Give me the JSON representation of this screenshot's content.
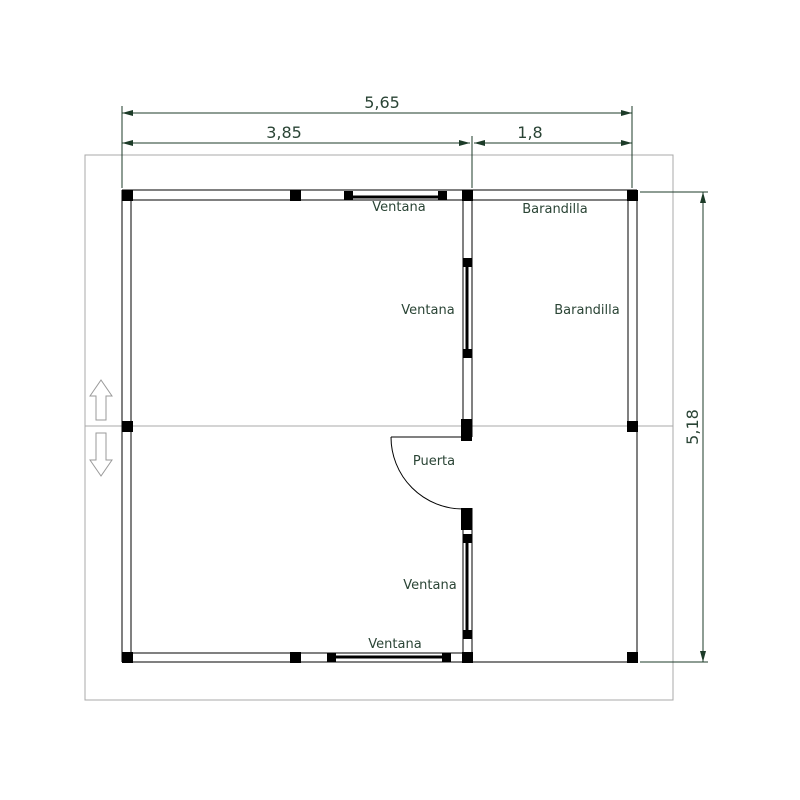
{
  "plan": {
    "title": "floor plan of cabin with porch",
    "labels": {
      "window_top": "Ventana",
      "window_mid_upper": "Ventana",
      "window_mid_lower": "Ventana",
      "window_bottom": "Ventana",
      "railing_top": "Barandilla",
      "railing_right": "Barandilla",
      "door": "Puerta"
    },
    "dimensions": {
      "total_width": "5,65",
      "room_width": "3,85",
      "porch_width": "1,8",
      "total_depth": "5,18"
    },
    "colors": {
      "drawing_lines": "#000000",
      "annotation": "#2a4435",
      "dimension_lines": "#1c3b28",
      "frame": "#a8a8a8",
      "background": "#ffffff"
    }
  }
}
